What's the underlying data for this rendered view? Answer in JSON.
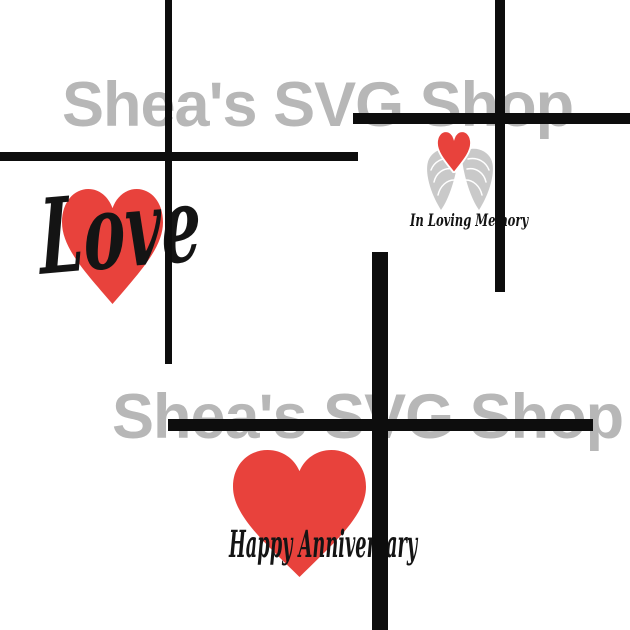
{
  "canvas": {
    "width": 630,
    "height": 630,
    "background": "#ffffff"
  },
  "watermark": {
    "text": "Shea's SVG Shop",
    "color": "#b7b7b7"
  },
  "colors": {
    "heart_red": "#e8423c",
    "cross_black": "#0d0d0d",
    "wing_gray": "#c9c9c9",
    "script_black": "#141414"
  },
  "designs": {
    "love": {
      "label": "Love"
    },
    "in_loving_memory": {
      "label": "In Loving Memory"
    },
    "happy_anniversary": {
      "label": "Happy Anniversary"
    }
  }
}
